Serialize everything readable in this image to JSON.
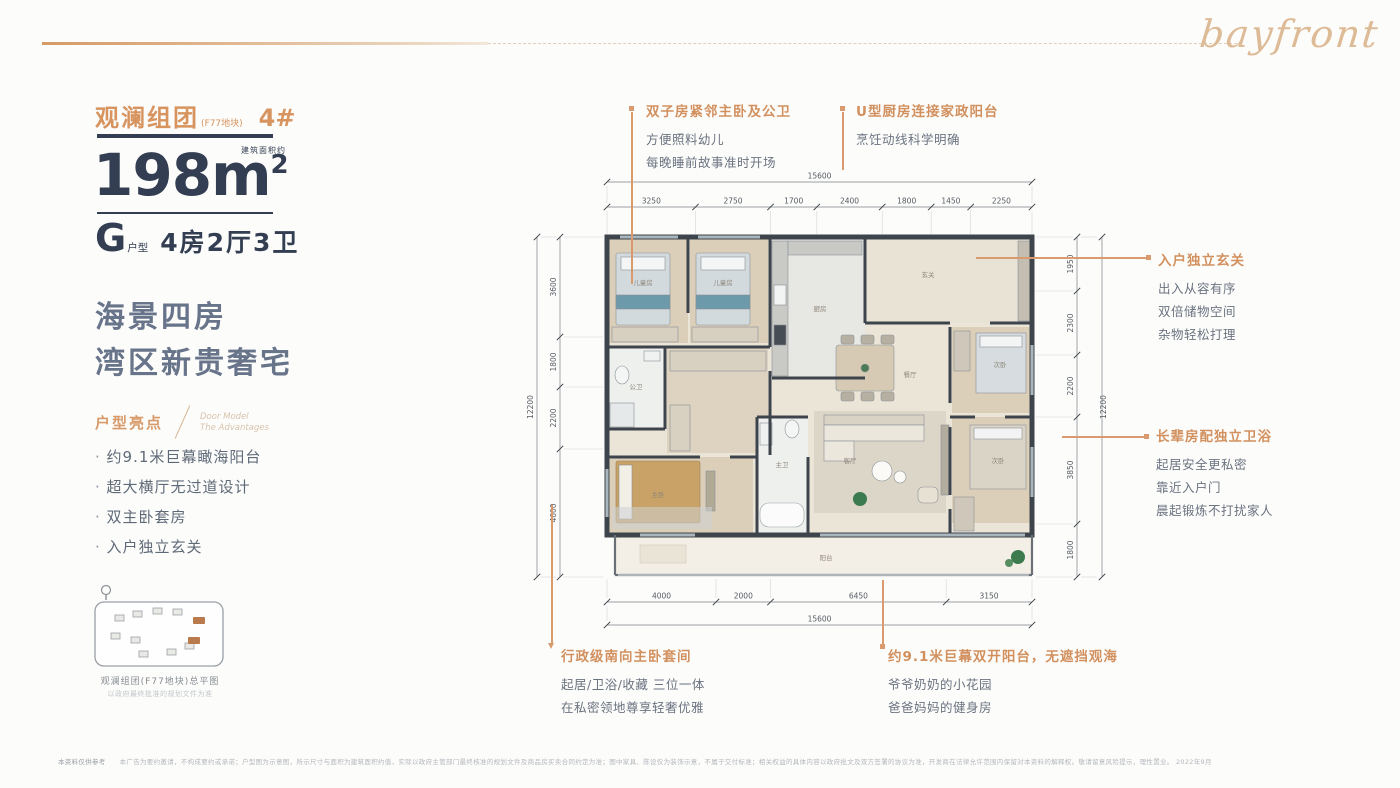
{
  "brand": {
    "logo": "bayfront"
  },
  "left_panel": {
    "group_title": "观澜组团",
    "group_paren": "(F77地块)",
    "unit_no": "4#",
    "area_value": "198",
    "area_unit": "m",
    "area_sup": "2",
    "area_note": "建筑面积约",
    "type_letter": "G",
    "type_label": "户型",
    "type_desc": "4房2厅3卫",
    "slogan1": "海景四房",
    "slogan2": "湾区新贵奢宅",
    "hl_title": "户型亮点",
    "hl_en1": "Door Model",
    "hl_en2": "The Advantages",
    "highlights": [
      "约9.1米巨幕瞰海阳台",
      "超大横厅无过道设计",
      "双主卧套房",
      "入户独立玄关"
    ],
    "map_caption": "观澜组团(F77地块)总平图",
    "map_note": "以政府最终批准的规划文件为准"
  },
  "callouts": {
    "twins": {
      "title": "双子房紧邻主卧及公卫",
      "lines": [
        "方便照料幼儿",
        "每晚睡前故事准时开场"
      ]
    },
    "kitchen": {
      "title": "U型厨房连接家政阳台",
      "lines": [
        "烹饪动线科学明确"
      ]
    },
    "foyer": {
      "title": "入户独立玄关",
      "lines": [
        "出入从容有序",
        "双倍储物空间",
        "杂物轻松打理"
      ]
    },
    "elder": {
      "title": "长辈房配独立卫浴",
      "lines": [
        "起居安全更私密",
        "靠近入户门",
        "晨起锻炼不打扰家人"
      ]
    },
    "master": {
      "title": "行政级南向主卧套间",
      "lines": [
        "起居/卫浴/收藏 三位一体",
        "在私密领地尊享轻奢优雅"
      ]
    },
    "balcony": {
      "title": "约9.1米巨幕双开阳台，无遮挡观海",
      "lines": [
        "爷爷奶奶的小花园",
        "爸爸妈妈的健身房"
      ]
    }
  },
  "floorplan": {
    "dims": {
      "top_total": "15600",
      "top_segments": [
        "3250",
        "2750",
        "1700",
        "2400",
        "1800",
        "1450",
        "2250"
      ],
      "bottom_total": "15600",
      "bottom_segments": [
        "4000",
        "2000",
        "6450",
        "3150"
      ],
      "left_total": "12200",
      "left_segments": [
        "3600",
        "1800",
        "2200",
        "4600"
      ],
      "right_total": "12200",
      "right_segments": [
        "1950",
        "2300",
        "2200",
        "3850",
        "1800"
      ]
    },
    "rooms": [
      "儿童房",
      "儿童房",
      "公卫",
      "厨房",
      "玄关",
      "餐厅",
      "客厅",
      "主卧",
      "主卫",
      "次卧",
      "次卧",
      "阳台"
    ]
  },
  "footer": {
    "prefix": "本资料仅供参考",
    "text": "本广告为要约邀请，不构成要约或承诺；户型图为示意图，所示尺寸与面积为建筑面积约值，实际以政府主管部门最终核准的规划文件及商品房买卖合同约定为准；图中家具、陈设仅为装饰示意，不属于交付标准；相关权益的具体内容以政府批文及双方签署的协议为准，开发商在法律允许范围内保留对本资料的解释权。敬请留意风险提示，理性置业。 2022年9月"
  },
  "colors": {
    "accent_orange": "#d7945f",
    "navy": "#333e52",
    "gray_text": "#6b7380",
    "wall": "#3e444b"
  }
}
